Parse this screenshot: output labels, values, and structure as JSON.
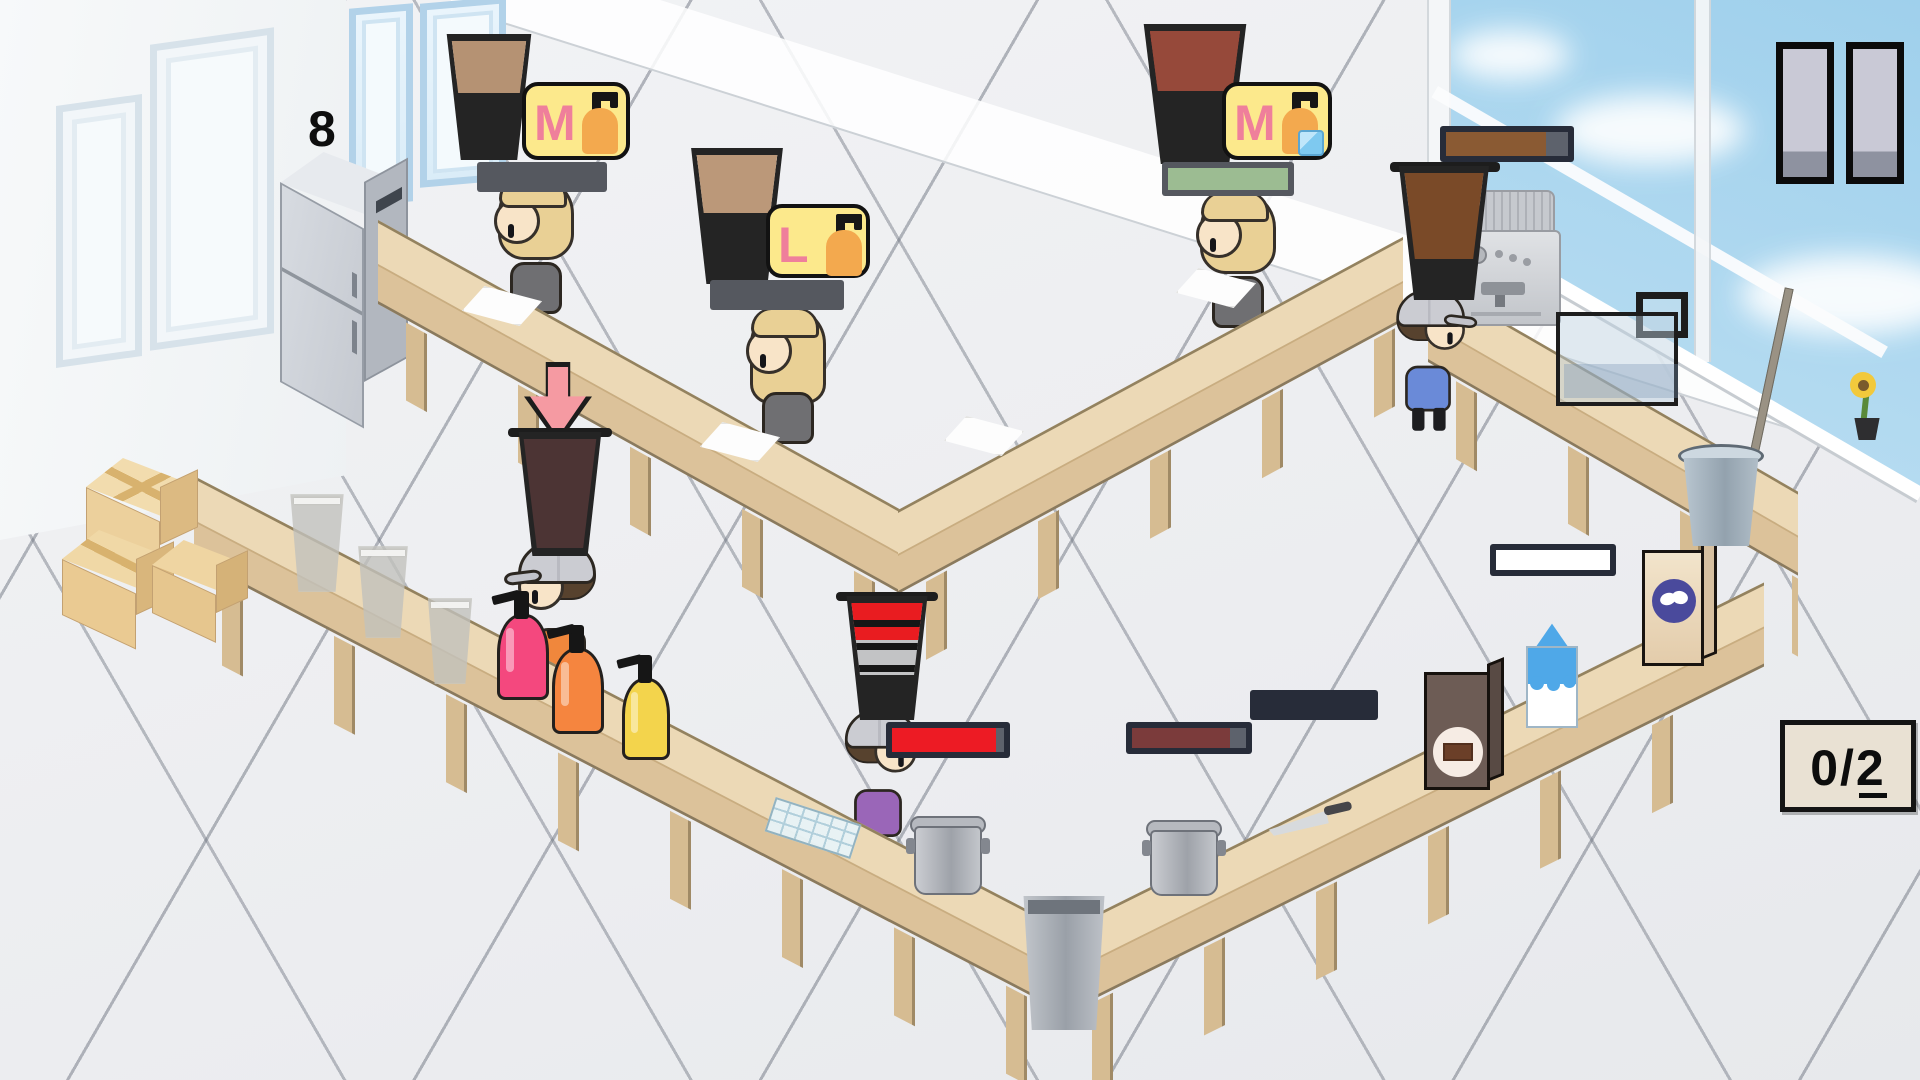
{
  "hud": {
    "pause_icon": "pause-icon",
    "goal_counter": "0/2",
    "fridge_stock": "8"
  },
  "orders": [
    {
      "size": "M",
      "addons": [
        "syrup-pump-bottle"
      ],
      "station": "top-left"
    },
    {
      "size": "L",
      "addons": [
        "syrup-pump-bottle"
      ],
      "station": "top-center"
    },
    {
      "size": "M",
      "addons": [
        "syrup-pump-bottle",
        "ice-cube"
      ],
      "station": "top-right"
    }
  ],
  "cups": {
    "latte_m": {
      "layers": [
        {
          "h": 16,
          "c": "#6a4a36"
        },
        {
          "h": 3,
          "c": "#47332a"
        },
        {
          "h": 34,
          "c": "#f3ede3"
        },
        {
          "h": 47,
          "c": "#b59273"
        }
      ]
    },
    "latte_l": {
      "layers": [
        {
          "h": 8,
          "c": "#fbf8f3"
        },
        {
          "h": 44,
          "c": "#f1ebdf"
        },
        {
          "h": 48,
          "c": "#bb9879"
        }
      ]
    },
    "berry_m": {
      "layers": [
        {
          "h": 10,
          "c": "#e32531"
        },
        {
          "h": 42,
          "c": "#a2523f"
        },
        {
          "h": 48,
          "c": "#96493a"
        }
      ]
    },
    "coffee_brew": {
      "layers": [
        {
          "h": 28,
          "c": "rgba(233,235,237,0.72)"
        },
        {
          "h": 72,
          "c": "#7a4a28"
        }
      ]
    },
    "dark_full": {
      "layers": [
        {
          "h": 100,
          "c": "#4c3434"
        }
      ]
    },
    "measure_red": {
      "layers": [
        {
          "h": 66,
          "c": "rgba(238,240,242,0.78)"
        },
        {
          "h": 34,
          "c": "#e91c20"
        }
      ]
    }
  },
  "bars": {
    "b1": {
      "kind": "segments",
      "values": [
        1,
        0,
        0,
        0,
        0
      ],
      "on": "#9bba8c",
      "off": "#70757d"
    },
    "b2": {
      "kind": "segments",
      "values": [
        1,
        0,
        0,
        0,
        0
      ],
      "on": "#9bba8c",
      "off": "#70757d"
    },
    "b3": {
      "kind": "fill",
      "pct": 100,
      "color": "#9cbc92"
    },
    "b4": {
      "kind": "fill",
      "pct": 82,
      "color": "#8a5a33"
    },
    "b5": {
      "kind": "fill",
      "pct": 93,
      "color": "#ed1b24"
    },
    "b6": {
      "kind": "segments",
      "values": [
        0,
        0,
        0,
        0,
        0
      ],
      "on": "#9bba8c",
      "off": "#61666f"
    },
    "b7": {
      "kind": "fill",
      "pct": 86,
      "color": "#7b3b3b"
    },
    "b8": {
      "kind": "fill",
      "pct": 100,
      "color": "#ffffff"
    }
  },
  "palette": {
    "bubble_bg": "#fce98c",
    "bubble_letter": "#ef7f9b",
    "syrup_orange": "#f3a94e",
    "counter_top": "#ecd9b6",
    "counter_front": "#dcc29a",
    "shirt_customer": "#6f6f72",
    "shirt_worker1": "#f0873c",
    "shirt_worker2": "#9a66b8",
    "shirt_worker3": "#6a8ad8",
    "bottle_pink": "#f4487e",
    "bottle_orange": "#f5853f",
    "bottle_yellow": "#f3d44c",
    "arrow_pink": "#f59aa2",
    "score_bg": "#e9e1d3",
    "sky": "#c2e2f4"
  }
}
